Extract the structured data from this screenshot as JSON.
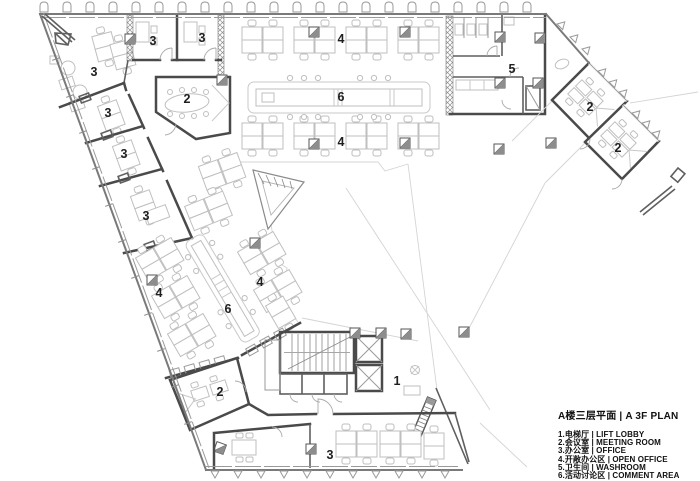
{
  "legend": {
    "title": "A楼三层平面 | A 3F PLAN",
    "items": [
      "1.电梯厅 | LIFT LOBBY",
      "2.会议室 | MEETING ROOM",
      "3.办公室 | OFFICE",
      "4.开敞办公区 | OPEN OFFICE",
      "5.卫生间 | WASHROOM",
      "6.活动讨论区 | COMMENT AREA"
    ]
  },
  "rooms": {
    "lift_lobby": {
      "number": "1",
      "name_zh": "电梯厅",
      "name_en": "LIFT LOBBY"
    },
    "meeting_room": {
      "number": "2",
      "name_zh": "会议室",
      "name_en": "MEETING ROOM"
    },
    "office": {
      "number": "3",
      "name_zh": "办公室",
      "name_en": "OFFICE"
    },
    "open_office": {
      "number": "4",
      "name_zh": "开敞办公区",
      "name_en": "OPEN OFFICE"
    },
    "washroom": {
      "number": "5",
      "name_zh": "卫生间",
      "name_en": "WASHROOM"
    },
    "comment_area": {
      "number": "6",
      "name_zh": "活动讨论区",
      "name_en": "COMMENT AREA"
    }
  },
  "colors": {
    "background": "#ffffff",
    "wall_dark": "#4a4a4a",
    "wall_light": "#9a9a9a",
    "furniture": "#bfbfbf",
    "text": "#1f1f1f"
  }
}
